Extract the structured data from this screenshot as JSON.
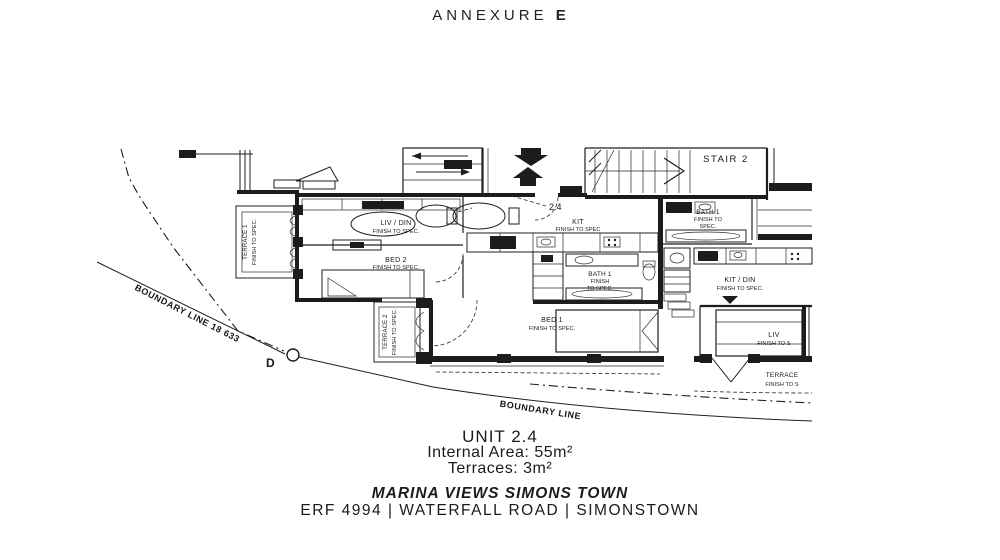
{
  "header": {
    "annexure": "ANNEXURE",
    "annexure_letter": "E"
  },
  "plan": {
    "unit_marker": "2.4",
    "beacon": "D",
    "boundary_line_1": "BOUNDARY LINE 18 633",
    "boundary_line_2": "BOUNDARY LINE",
    "stair2": "STAIR 2",
    "rooms": {
      "terrace1": {
        "name": "TERRACE 1",
        "spec": "FINISH TO SPEC."
      },
      "livdin": {
        "name": "LIV / DIN",
        "spec": "FINISH TO SPEC."
      },
      "bed2": {
        "name": "BED 2",
        "spec": "FINISH TO SPEC."
      },
      "terrace2": {
        "name": "TERRACE 2",
        "spec": "FINISH TO SPEC."
      },
      "kit": {
        "name": "KIT",
        "spec": "FINISH TO SPEC"
      },
      "bath1_main": {
        "name": "BATH 1",
        "spec_l1": "FINISH",
        "spec_l2": "TO SPEC."
      },
      "bed1": {
        "name": "BED 1",
        "spec": "FINISH TO SPEC."
      },
      "bath1_adj": {
        "name": "BATH 1",
        "spec_l1": "FINISH TO",
        "spec_l2": "SPEC."
      },
      "kitdin": {
        "name": "KIT / DIN",
        "spec": "FINISH TO SPEC."
      },
      "liv_adj": {
        "name": "LIV",
        "spec": "FINISH TO S"
      },
      "terrace_adj": {
        "name": "TERRACE",
        "spec": "FINISH TO S"
      }
    }
  },
  "footer": {
    "unit": "UNIT 2.4",
    "internal_area": "Internal Area: 55m²",
    "terraces": "Terraces: 3m²",
    "project": "MARINA VIEWS SIMONS TOWN",
    "address": "ERF 4994 | WATERFALL ROAD | SIMONSTOWN"
  }
}
